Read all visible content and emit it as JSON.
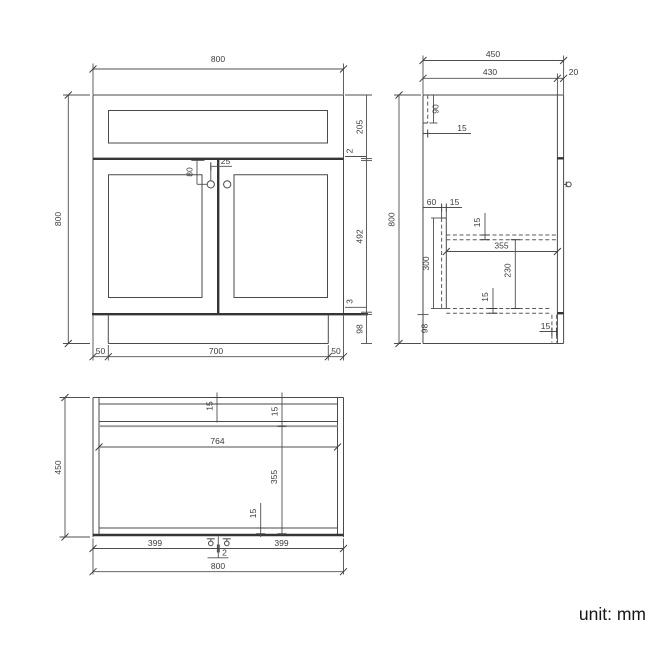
{
  "drawing": {
    "front": {
      "width_top": "800",
      "height_left": "800",
      "drawer_height": "205",
      "gap_drawer_door": "2",
      "door_height": "492",
      "gap_door_plinth": "3",
      "plinth_height": "98",
      "plinth_inset_left": "50",
      "plinth_width": "700",
      "plinth_inset_right": "50",
      "knob_drop": "80",
      "knob_offset": "25"
    },
    "side": {
      "depth_total": "450",
      "depth_carcass": "430",
      "door_thickness": "20",
      "height_left": "800",
      "back_rail_height": "90",
      "back_rail_thickness": "15",
      "bar_offset": "60",
      "bar_thickness": "15",
      "bar_height": "300",
      "shelf_thickness": "15",
      "shelf_depth": "355",
      "under_shelf_height": "230",
      "bottom_thickness": "15",
      "plinth_recess": "15",
      "plinth_height": "98"
    },
    "plan": {
      "depth_left": "450",
      "back_thickness": "15",
      "rail_thickness": "15",
      "inner_width": "764",
      "shelf_depth": "355",
      "front_rail_thickness": "15",
      "door_left_width": "399",
      "door_gap": "2",
      "door_right_width": "399",
      "width_bottom": "800"
    },
    "footer": {
      "unit_label": "unit: mm"
    }
  }
}
